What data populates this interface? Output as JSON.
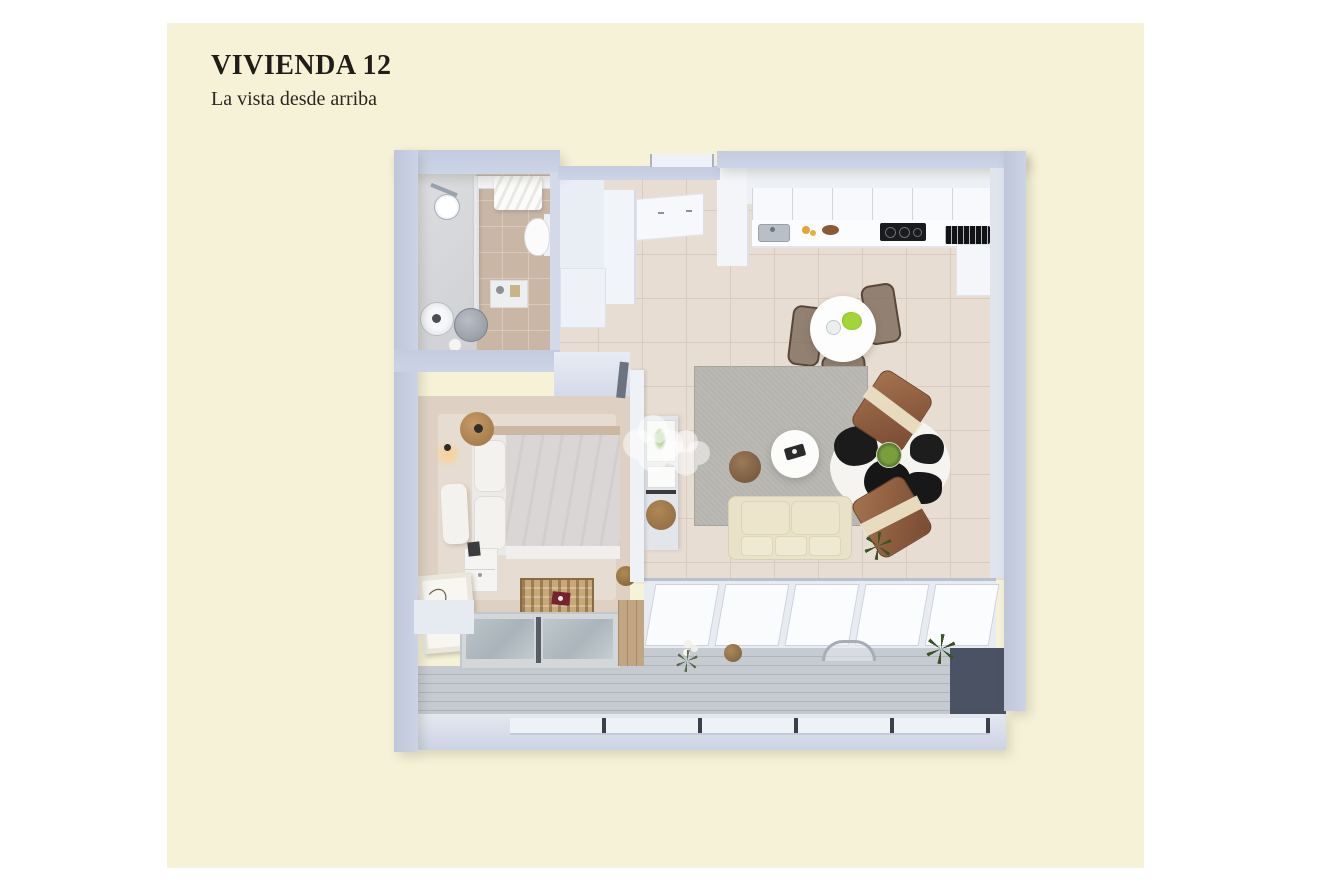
{
  "header": {
    "title": "VIVIENDA 12",
    "subtitle": "La vista desde arriba"
  },
  "palette": {
    "page_bg": "#ffffff",
    "panel_bg": "#f6f2d8",
    "title_color": "#1f1d17",
    "wall_outer": "#c6cde0",
    "wall_interior": "#eef1f5",
    "floor_tile": "#e7ddd2",
    "bathroom_tile": "#c9b6a4",
    "shower_floor": "#d5d6d9",
    "bedroom_floor": "#ded1c3",
    "area_rug_gray": "#b6b4ae",
    "sofa_cream": "#e9e2c8",
    "leather_brown": "#98684f",
    "wood": "#b88d5c",
    "terrace_deck": "#c0c5cb",
    "dark_wall": "#4a5263",
    "window_glass": "#b3bdc3",
    "plant_green": "#a3d438",
    "cowhide_black": "#1b1b1b",
    "watermark_white": "rgba(255,255,255,0.5)"
  },
  "plan": {
    "rooms": [
      {
        "name": "bathroom"
      },
      {
        "name": "entry-hall"
      },
      {
        "name": "kitchen"
      },
      {
        "name": "dining-area"
      },
      {
        "name": "living-room"
      },
      {
        "name": "bedroom"
      },
      {
        "name": "terrace"
      }
    ],
    "furniture_icons": [
      "shower-icon",
      "toilet-icon",
      "vessel-sink-icon",
      "washer-icon",
      "towel-icon",
      "wardrobe-icon",
      "fridge-icon",
      "cooktop-icon",
      "kitchen-sink-icon",
      "fruit-bowl-icon",
      "dining-table-icon",
      "chair-icon",
      "area-rug-icon",
      "pouf-icon",
      "coffee-table-icon",
      "cowhide-rug-icon",
      "lounge-chair-icon",
      "sofa-icon",
      "plant-icon",
      "bed-icon",
      "nightstand-icon",
      "wall-lamp-icon",
      "picture-frame-icon",
      "storage-bench-icon",
      "sliding-door-icon",
      "deck-icon",
      "glass-railing-icon",
      "watermark-logo-icon"
    ]
  }
}
